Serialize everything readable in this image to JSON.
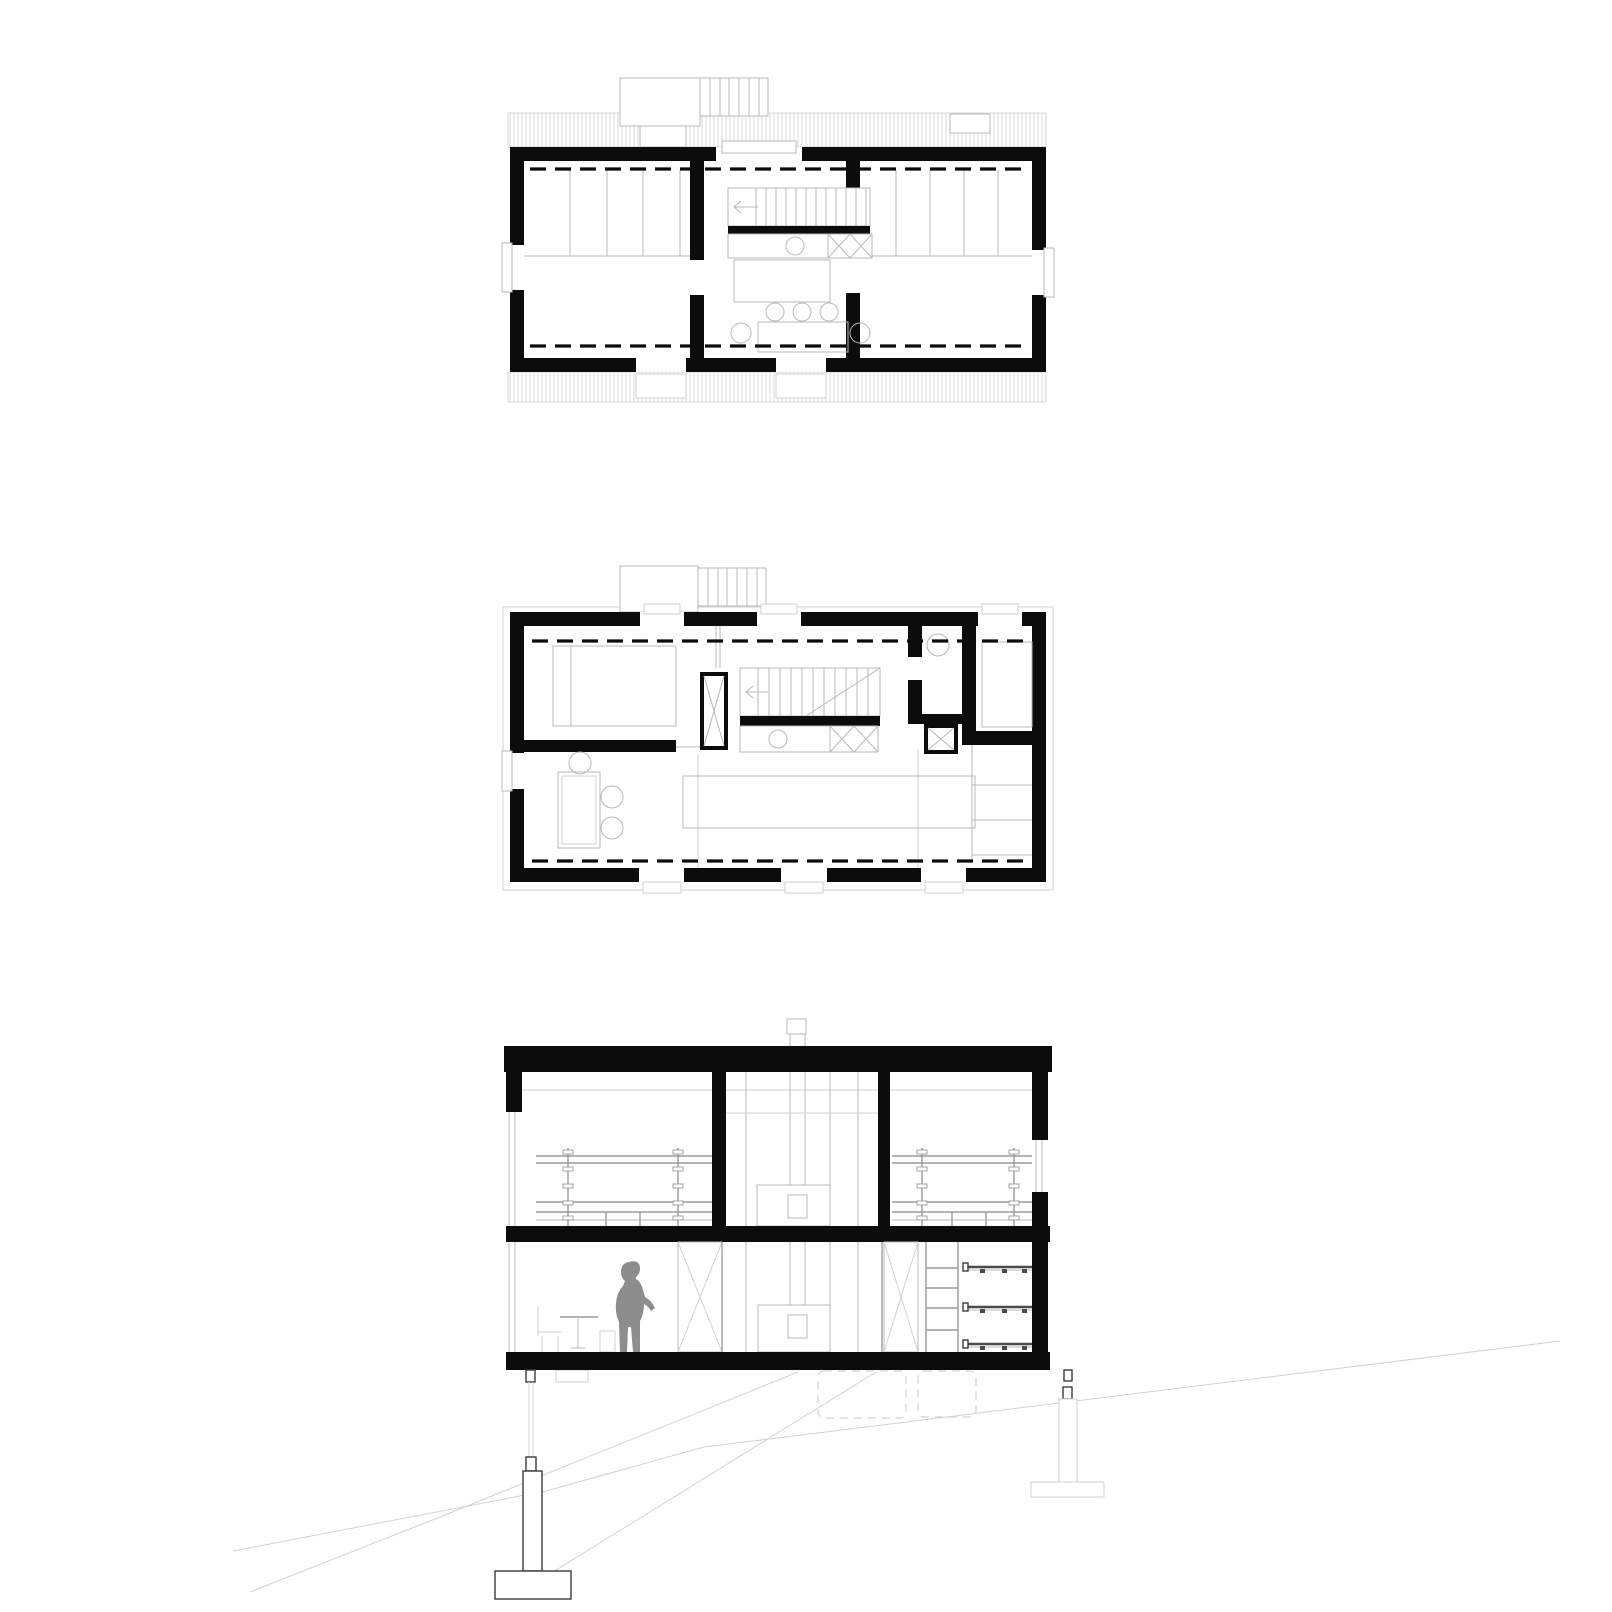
{
  "drawing": {
    "figure_count": 3,
    "figures": [
      {
        "id": "upper-floor-plan",
        "kind": "floor-plan",
        "rooms": [
          "bedroom-left",
          "stair-bath-core",
          "bedroom-right"
        ],
        "stair_tread_count": 12,
        "exterior_stair_tread_count": 6,
        "window_count": 5,
        "stool_count": 5
      },
      {
        "id": "ground-floor-plan",
        "kind": "floor-plan",
        "rooms": [
          "bedroom-nw",
          "stair-core",
          "wc",
          "bedroom-ne",
          "living-dining-kitchen"
        ],
        "stair_tread_count": 11,
        "window_count": 7,
        "chair_count": 3,
        "kitchen_shelf_count": 3
      },
      {
        "id": "cross-section",
        "kind": "section",
        "levels": 2,
        "shelf_count": 3,
        "ladder_rung_count": 4,
        "stilt_count": 2,
        "person_count": 1,
        "has_chimney": true,
        "terrain": "sloped"
      }
    ]
  },
  "palette": {
    "ink": "#0c0c0c",
    "light": "#b9b9b9",
    "lighter": "#d2d2d2",
    "mid": "#9a9a9a",
    "figure": "#8d8d8d",
    "hatch": "#d8d8d8",
    "background": "#ffffff"
  }
}
